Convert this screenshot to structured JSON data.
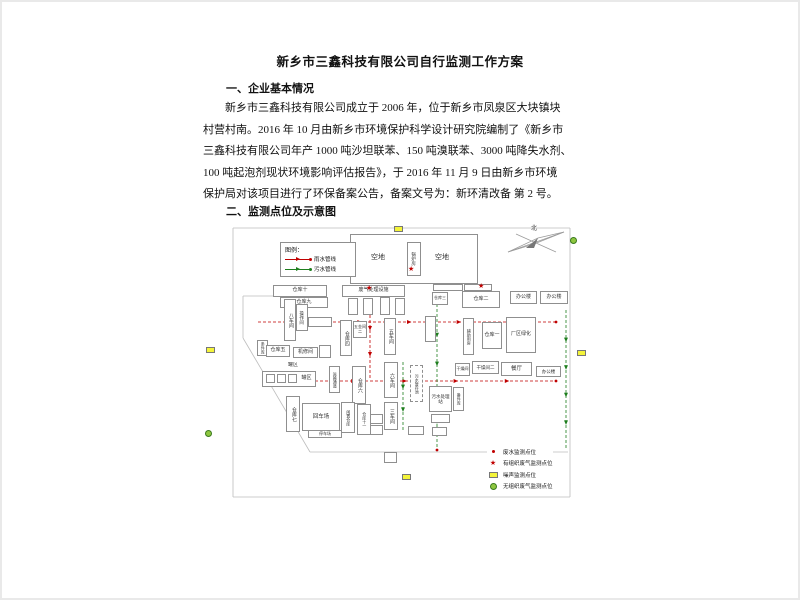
{
  "document": {
    "title": "新乡市三鑫科技有限公司自行监测工作方案",
    "section1_heading": "一、企业基本情况",
    "paragraph_lines": [
      "新乡市三鑫科技有限公司成立于 2006 年，位于新乡市凤泉区大块镇块",
      "村营村南。2016 年 10 月由新乡市环境保护科学设计研究院编制了《新乡市",
      "三鑫科技有限公司年产 1000 吨沙坦联苯、150 吨溴联苯、3000 吨降失水剂、",
      "100 吨起泡剂现状环境影响评估报告》，于 2016 年 11 月 9 日由新乡市环境",
      "保护局对该项目进行了环保备案公告，备案文号为：新环清改备 第 2 号。"
    ],
    "section2_heading": "二、监测点位及示意图"
  },
  "diagram": {
    "compass_label": "北",
    "colors": {
      "rain_line": "#c00000",
      "sewage_line": "#1e7e1e",
      "noise_marker": "#f4f43a",
      "fugitive_gas_marker": "#8ec63f",
      "stack_gas_marker": "#c00000"
    },
    "legend_pipelines": {
      "title": "图例：",
      "items": [
        {
          "label": "雨水管线",
          "color": "#c00000"
        },
        {
          "label": "污水管线",
          "color": "#1e7e1e"
        }
      ]
    },
    "legend_monitoring": {
      "items": [
        {
          "type": "red-dot",
          "label": "废水监测点位"
        },
        {
          "type": "red-star",
          "label": "有组织废气监测点位"
        },
        {
          "type": "yellow-rect",
          "label": "噪声监测点位"
        },
        {
          "type": "green-circle",
          "label": "无组织废气监测点位"
        }
      ]
    },
    "buildings": [
      {
        "label": "",
        "x": 350,
        "y": 234,
        "w": 128,
        "h": 50
      },
      {
        "label": "空地",
        "x": 364,
        "y": 251,
        "w": 28,
        "h": 12,
        "nob": true,
        "fs": 7
      },
      {
        "label": "锅炉房",
        "x": 407,
        "y": 242,
        "w": 14,
        "h": 34,
        "o": "v",
        "fs": 4.5
      },
      {
        "label": "空地",
        "x": 428,
        "y": 251,
        "w": 28,
        "h": 12,
        "nob": true,
        "fs": 7
      },
      {
        "label": "仓库十",
        "x": 273,
        "y": 285,
        "w": 54,
        "h": 12,
        "fs": 5
      },
      {
        "label": "仓库九",
        "x": 280,
        "y": 297,
        "w": 48,
        "h": 11,
        "fs": 5
      },
      {
        "label": "八车间",
        "x": 284,
        "y": 299,
        "w": 12,
        "h": 42,
        "o": "v",
        "fs": 5
      },
      {
        "label": "操作间",
        "x": 296,
        "y": 304,
        "w": 12,
        "h": 27,
        "o": "v",
        "fs": 4.5
      },
      {
        "label": "",
        "x": 308,
        "y": 317,
        "w": 24,
        "h": 10
      },
      {
        "label": "条件库",
        "x": 257,
        "y": 340,
        "w": 11,
        "h": 16,
        "o": "v",
        "fs": 4
      },
      {
        "label": "仓库五",
        "x": 266,
        "y": 345,
        "w": 24,
        "h": 12,
        "fs": 5
      },
      {
        "label": "机修间",
        "x": 293,
        "y": 347,
        "w": 25,
        "h": 11,
        "fs": 5
      },
      {
        "label": "",
        "x": 319,
        "y": 345,
        "w": 12,
        "h": 13
      },
      {
        "label": "废气处理设施",
        "x": 342,
        "y": 285,
        "w": 63,
        "h": 12,
        "fs": 5
      },
      {
        "label": "",
        "x": 348,
        "y": 298,
        "w": 10,
        "h": 17
      },
      {
        "label": "",
        "x": 363,
        "y": 298,
        "w": 10,
        "h": 17
      },
      {
        "label": "",
        "x": 380,
        "y": 297,
        "w": 10,
        "h": 18
      },
      {
        "label": "",
        "x": 395,
        "y": 298,
        "w": 10,
        "h": 17
      },
      {
        "label": "仓库四",
        "x": 340,
        "y": 320,
        "w": 12,
        "h": 36,
        "o": "v",
        "fs": 5
      },
      {
        "label": "五金间二",
        "x": 353,
        "y": 321,
        "w": 14,
        "h": 17,
        "fs": 4
      },
      {
        "label": "五车间",
        "x": 384,
        "y": 318,
        "w": 12,
        "h": 37,
        "o": "v",
        "fs": 5
      },
      {
        "label": "",
        "x": 425,
        "y": 316,
        "w": 11,
        "h": 26
      },
      {
        "label": "仓库三",
        "x": 432,
        "y": 292,
        "w": 16,
        "h": 13,
        "fs": 4
      },
      {
        "label": "仓库二",
        "x": 462,
        "y": 291,
        "w": 38,
        "h": 17,
        "fs": 5
      },
      {
        "label": "办公楼",
        "x": 510,
        "y": 291,
        "w": 27,
        "h": 13,
        "fs": 5
      },
      {
        "label": "办公楼",
        "x": 540,
        "y": 291,
        "w": 28,
        "h": 13,
        "fs": 5
      },
      {
        "label": "辅助用房",
        "x": 463,
        "y": 318,
        "w": 11,
        "h": 37,
        "o": "v",
        "fs": 4
      },
      {
        "label": "仓库一",
        "x": 482,
        "y": 322,
        "w": 20,
        "h": 27,
        "fs": 5
      },
      {
        "label": "厂区绿化",
        "x": 506,
        "y": 317,
        "w": 30,
        "h": 36,
        "fs": 5
      },
      {
        "label": "干燥间",
        "x": 455,
        "y": 363,
        "w": 15,
        "h": 13,
        "fs": 4
      },
      {
        "label": "干燥间二",
        "x": 472,
        "y": 361,
        "w": 27,
        "h": 13,
        "fs": 4.5
      },
      {
        "label": "餐厅",
        "x": 501,
        "y": 362,
        "w": 31,
        "h": 14,
        "fs": 5.5
      },
      {
        "label": "办公楼",
        "x": 536,
        "y": 366,
        "w": 25,
        "h": 11,
        "fs": 4.5
      },
      {
        "label": "罐区",
        "x": 286,
        "y": 362,
        "w": 14,
        "h": 8,
        "nob": true,
        "fs": 5
      },
      {
        "label": "",
        "x": 262,
        "y": 371,
        "w": 54,
        "h": 16
      },
      {
        "label": "",
        "x": 266,
        "y": 374,
        "w": 9,
        "h": 9
      },
      {
        "label": "",
        "x": 277,
        "y": 374,
        "w": 9,
        "h": 9
      },
      {
        "label": "",
        "x": 288,
        "y": 374,
        "w": 9,
        "h": 9
      },
      {
        "label": "罐区",
        "x": 300,
        "y": 374,
        "w": 13,
        "h": 10,
        "nob": true,
        "fs": 5
      },
      {
        "label": "运输通道",
        "x": 329,
        "y": 366,
        "w": 11,
        "h": 27,
        "o": "v",
        "fs": 4
      },
      {
        "label": "仓库六",
        "x": 352,
        "y": 366,
        "w": 14,
        "h": 38,
        "o": "v",
        "fs": 5
      },
      {
        "label": "六车间",
        "x": 384,
        "y": 362,
        "w": 14,
        "h": 36,
        "o": "v",
        "fs": 5
      },
      {
        "label": "三车间",
        "x": 384,
        "y": 402,
        "w": 14,
        "h": 28,
        "o": "v",
        "fs": 5
      },
      {
        "label": "污水暂存池",
        "x": 410,
        "y": 365,
        "w": 13,
        "h": 37,
        "o": "v",
        "dashed": true,
        "fs": 4
      },
      {
        "label": "污水处理站",
        "x": 429,
        "y": 386,
        "w": 23,
        "h": 26,
        "fs": 4.5
      },
      {
        "label": "备件库",
        "x": 453,
        "y": 387,
        "w": 11,
        "h": 24,
        "o": "v",
        "fs": 4
      },
      {
        "label": "仓库七",
        "x": 286,
        "y": 396,
        "w": 14,
        "h": 36,
        "o": "v",
        "fs": 5
      },
      {
        "label": "回车场",
        "x": 302,
        "y": 403,
        "w": 38,
        "h": 28,
        "fs": 5.5
      },
      {
        "label": "闲置仓库",
        "x": 341,
        "y": 402,
        "w": 14,
        "h": 31,
        "o": "v",
        "fs": 4
      },
      {
        "label": "仓库十一",
        "x": 357,
        "y": 404,
        "w": 14,
        "h": 31,
        "o": "v",
        "fs": 4
      },
      {
        "label": "停车场",
        "x": 308,
        "y": 430,
        "w": 34,
        "h": 8,
        "fs": 4
      },
      {
        "label": "",
        "x": 370,
        "y": 414,
        "w": 13,
        "h": 10
      },
      {
        "label": "",
        "x": 370,
        "y": 425,
        "w": 13,
        "h": 10
      },
      {
        "label": "",
        "x": 408,
        "y": 426,
        "w": 16,
        "h": 9
      },
      {
        "label": "",
        "x": 431,
        "y": 414,
        "w": 19,
        "h": 9
      },
      {
        "label": "",
        "x": 432,
        "y": 427,
        "w": 15,
        "h": 9
      },
      {
        "label": "",
        "x": 384,
        "y": 452,
        "w": 13,
        "h": 11
      },
      {
        "label": "",
        "x": 433,
        "y": 284,
        "w": 30,
        "h": 7
      },
      {
        "label": "",
        "x": 464,
        "y": 284,
        "w": 28,
        "h": 7
      }
    ],
    "markers": [
      {
        "type": "yellow-rect",
        "x": 394,
        "y": 226
      },
      {
        "type": "yellow-rect",
        "x": 206,
        "y": 347
      },
      {
        "type": "yellow-rect",
        "x": 577,
        "y": 350
      },
      {
        "type": "yellow-rect",
        "x": 402,
        "y": 474
      },
      {
        "type": "green-circle",
        "x": 570,
        "y": 237
      },
      {
        "type": "green-circle",
        "x": 205,
        "y": 430
      },
      {
        "type": "red-star",
        "x": 408,
        "y": 266
      },
      {
        "type": "red-star",
        "x": 366,
        "y": 285
      },
      {
        "type": "red-star",
        "x": 478,
        "y": 283
      }
    ],
    "dots": [
      {
        "x": 556,
        "y": 322
      },
      {
        "x": 556,
        "y": 381
      },
      {
        "x": 437,
        "y": 450
      },
      {
        "x": 302,
        "y": 322
      }
    ],
    "boundary_lines": [
      [
        233,
        228,
        570,
        228
      ],
      [
        570,
        228,
        570,
        497
      ],
      [
        233,
        497,
        570,
        497
      ],
      [
        233,
        228,
        233,
        497
      ],
      [
        243,
        296,
        243,
        338
      ],
      [
        243,
        338,
        310,
        452
      ],
      [
        310,
        452,
        568,
        452
      ],
      [
        243,
        296,
        281,
        296
      ]
    ],
    "pipelines": [
      {
        "color": "#c00000",
        "x1": 258,
        "y1": 322,
        "x2": 556,
        "y2": 322,
        "arrows": 5
      },
      {
        "color": "#c00000",
        "x1": 300,
        "y1": 381,
        "x2": 556,
        "y2": 381,
        "arrows": 4
      },
      {
        "color": "#c00000",
        "x1": 370,
        "y1": 300,
        "x2": 370,
        "y2": 378,
        "arrows": 2
      },
      {
        "color": "#1e7e1e",
        "x1": 437,
        "y1": 304,
        "x2": 437,
        "y2": 448,
        "arrows": 4
      },
      {
        "color": "#1e7e1e",
        "x1": 403,
        "y1": 362,
        "x2": 403,
        "y2": 430,
        "arrows": 2
      },
      {
        "color": "#1e7e1e",
        "x1": 566,
        "y1": 310,
        "x2": 566,
        "y2": 448,
        "arrows": 4
      }
    ]
  }
}
